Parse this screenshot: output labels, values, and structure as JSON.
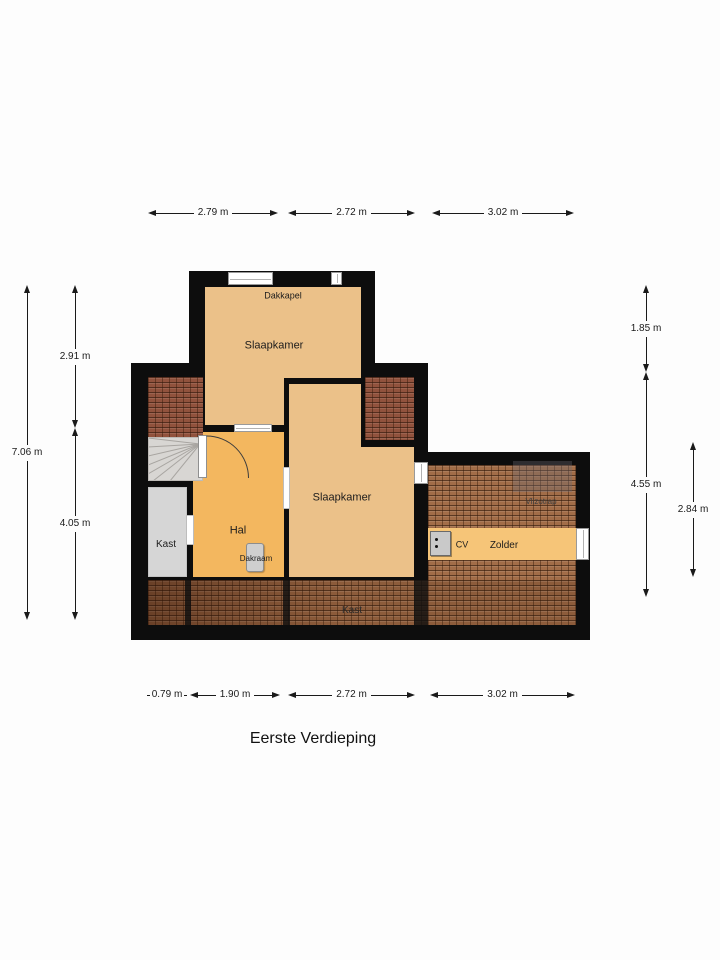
{
  "title": "Eerste Verdieping",
  "rooms": {
    "slaapkamer_top": "Slaapkamer",
    "slaapkamer_mid": "Slaapkamer",
    "hal": "Hal",
    "kast_left": "Kast",
    "kast_bottom": "Kast",
    "zolder": "Zolder",
    "cv": "CV",
    "dakkapel": "Dakkapel",
    "dakraam": "Dakraam",
    "vlizotrap": "Vlizotrap"
  },
  "dimensions": {
    "top": [
      {
        "label": "2.79 m"
      },
      {
        "label": "2.72 m"
      },
      {
        "label": "3.02 m"
      }
    ],
    "bottom": [
      {
        "label": "0.79 m"
      },
      {
        "label": "1.90 m"
      },
      {
        "label": "2.72 m"
      },
      {
        "label": "3.02 m"
      }
    ],
    "left": [
      {
        "label": "2.91 m"
      },
      {
        "label": "7.06 m"
      },
      {
        "label": "4.05 m"
      }
    ],
    "right": [
      {
        "label": "1.85 m"
      },
      {
        "label": "4.55 m"
      },
      {
        "label": "2.84 m"
      }
    ]
  },
  "colors": {
    "wall": "#0d0d0d",
    "room_tan": "#ebc189",
    "room_orange": "#f3b75f",
    "zolder_strip": "#f6c578",
    "closet_gray": "#d6d6d6",
    "tiles_brown": "#a26d48",
    "tiles_red": "#91523d"
  }
}
